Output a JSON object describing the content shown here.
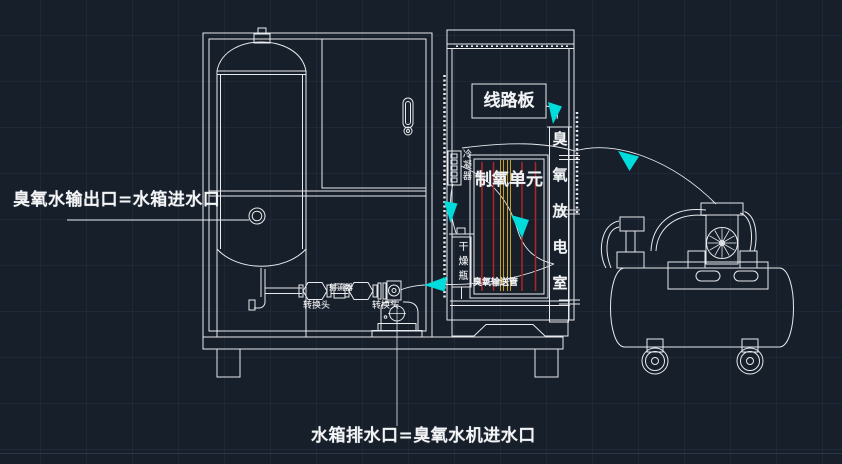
{
  "colors": {
    "line": "#e8eaed",
    "accent_cyan": "#00dcdc",
    "red": "#b22525",
    "yellow": "#c8a21e"
  },
  "labels": {
    "outlet": "臭氧水输出口=水箱进水口",
    "drain": "水箱排水口=臭氧水机进水口",
    "circuit_board": "线路板",
    "oxygen_unit": "制氧单元",
    "discharge_chamber": "臭氧放电室",
    "condenser": "冷凝器",
    "dryer_bottle": "干燥瓶",
    "ozone_tube": "臭氧输送管",
    "jet_injector": "射流器",
    "adapter_left": "转换头",
    "adapter_right": "转换头"
  }
}
